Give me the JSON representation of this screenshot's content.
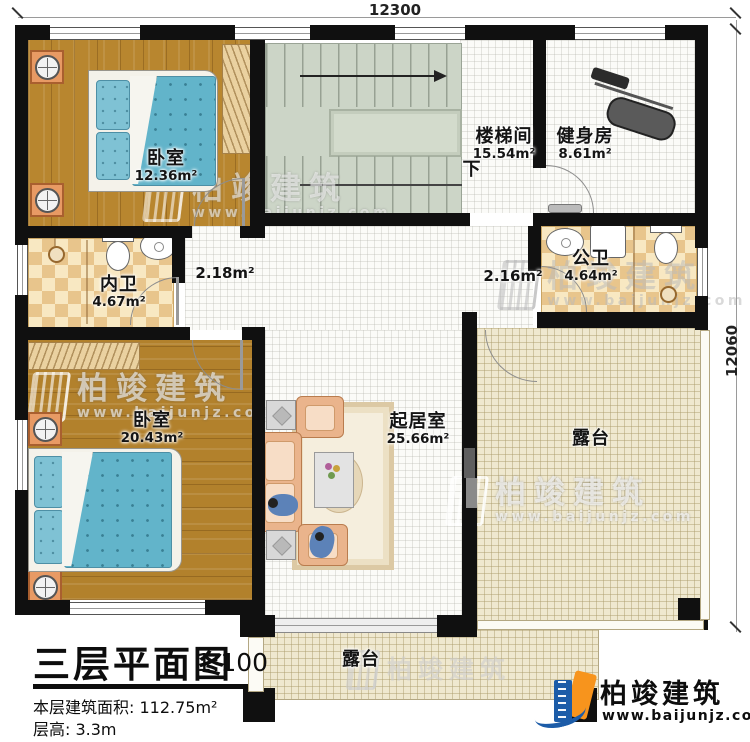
{
  "plan": {
    "dimensions": {
      "width_top": "12300",
      "height_right": "12060"
    },
    "rooms": [
      {
        "name": "卧室",
        "area": "12.36m²"
      },
      {
        "name": "楼梯间",
        "area": "15.54m²"
      },
      {
        "name": "健身房",
        "area": "8.61m²"
      },
      {
        "name": "内卫",
        "area": "4.67m²"
      },
      {
        "name": "公卫",
        "area": "4.64m²"
      },
      {
        "name": "卧室",
        "area": "20.43m²"
      },
      {
        "name": "起居室",
        "area": "25.66m²"
      },
      {
        "name": "露台"
      },
      {
        "name": "露台"
      }
    ],
    "hall_areas": [
      "2.18m²",
      "2.16m²"
    ],
    "stair_down_label": "下"
  },
  "title_block": {
    "title": "三层平面图",
    "scale": "1:100",
    "floor_area": "本层建筑面积: 112.75m²",
    "floor_height": "层高: 3.3m"
  },
  "branding": {
    "company": "柏竣建筑",
    "website": "www.baijunjz.com"
  },
  "colors": {
    "wall": "#101010",
    "wood_floor": "#b8862f",
    "stair_sage": "#ccd5c7",
    "bath_checker_dark": "#e8c58c",
    "bath_checker_light": "#f8e8c2",
    "terrace": "#efe8cf",
    "bed_blue": "#62b4ca",
    "sofa_peach": "#eab48c",
    "logo_blue": "#1c5ca8",
    "logo_orange": "#f7941d"
  }
}
